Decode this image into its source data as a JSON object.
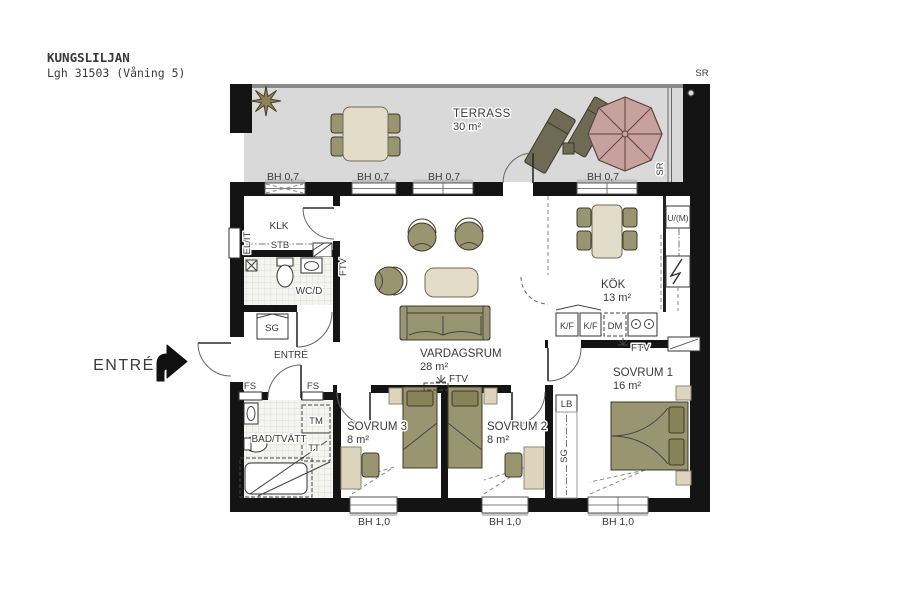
{
  "header": {
    "project": "KUNGSLILJAN",
    "apartment": "Lgh 31503 (Våning 5)"
  },
  "outside": {
    "entrance_label": "ENTRÉ"
  },
  "terrace": {
    "name": "TERRASS",
    "area": "30 m²",
    "downpipe_label": "SR"
  },
  "rooms": {
    "living": {
      "name": "VARDAGSRUM",
      "area": "28 m²"
    },
    "kitchen": {
      "name": "KÖK",
      "area": "13 m²"
    },
    "bedroom1": {
      "name": "SOVRUM 1",
      "area": "16 m²"
    },
    "bedroom2": {
      "name": "SOVRUM 2",
      "area": "8 m²"
    },
    "bedroom3": {
      "name": "SOVRUM 3",
      "area": "8 m²"
    },
    "bath": {
      "name": "BAD/TVÄTT"
    },
    "wc": {
      "name": "WC/D"
    },
    "walk_in_closet": {
      "name": "KLK"
    },
    "hall": {
      "name": "ENTRÉ"
    }
  },
  "fixtures": {
    "electrical_it": "EL/IT",
    "shelf": "STB",
    "wardrobe": "SG",
    "tv_outlet": "FTV",
    "fridge_freezer": "K/F",
    "dishwasher": "DM",
    "oven_microwave": "U/(M)",
    "linen_cabinet": "LB",
    "vent_slot": "FS",
    "washing_machine": "TM",
    "tumble_dryer": "TT"
  },
  "sills": {
    "upper": "BH 0,7",
    "lower": "BH 1,0"
  },
  "colors": {
    "wall": "#141414",
    "terrace_floor": "#d9d9d9",
    "furniture_olive": "#9a9571",
    "furniture_cream": "#e3dcc9",
    "furniture_tan": "#dcd4bd",
    "parasol": "#c7a19e",
    "text": "#3a3a3a"
  }
}
